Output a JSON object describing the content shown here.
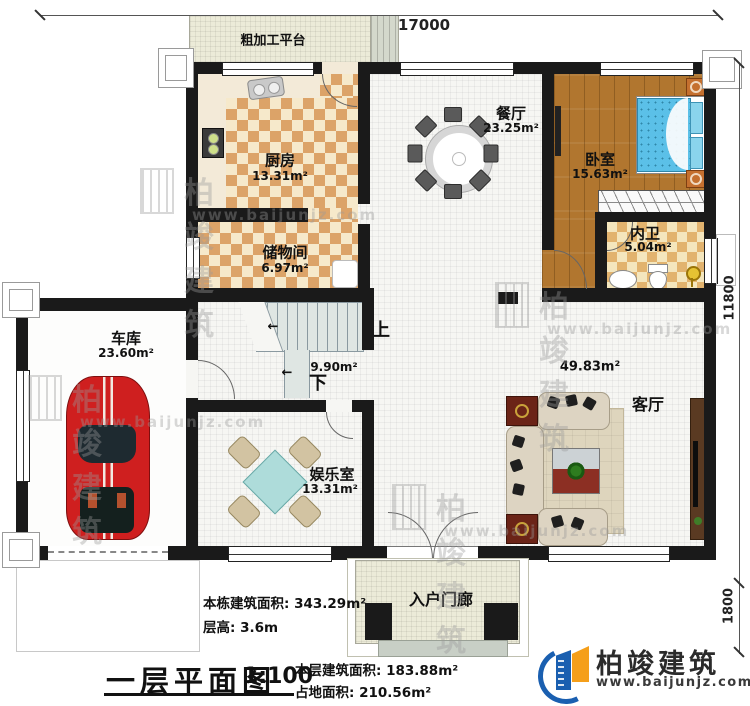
{
  "dimensions": {
    "top": "17000",
    "right": "11800",
    "porch": "1800"
  },
  "outdoor": {
    "platform": "粗加工平台",
    "porch": "入户门廊"
  },
  "rooms": [
    {
      "id": "kitchen",
      "name": "厨房",
      "area": "13.31m²"
    },
    {
      "id": "dining",
      "name": "餐厅",
      "area": "23.25m²"
    },
    {
      "id": "bedroom",
      "name": "卧室",
      "area": "15.63m²"
    },
    {
      "id": "bathroom",
      "name": "内卫",
      "area": "5.04m²"
    },
    {
      "id": "storage",
      "name": "储物间",
      "area": "6.97m²"
    },
    {
      "id": "garage",
      "name": "车库",
      "area": "23.60m²"
    },
    {
      "id": "entertainment",
      "name": "娱乐室",
      "area": "13.31m²"
    },
    {
      "id": "living",
      "name": "客厅",
      "area": "49.83m²"
    }
  ],
  "stairs": {
    "area": "9.90m²",
    "up_label": "上",
    "down_label": "下",
    "arrow": "←"
  },
  "titleblock": {
    "title": "一层平面图",
    "scale": "1:100",
    "building_total_area": "本栋建筑面积: 343.29m²",
    "floor_height": "层高: 3.6m",
    "floor_area": "本层建筑面积: 183.88m²",
    "footprint_area": "占地面积: 210.56m²"
  },
  "logo": {
    "brand": "柏竣建筑",
    "website": "www.baijunjz.com"
  },
  "watermark": {
    "brand": "柏竣建筑",
    "website": "www.baijunjz.com"
  },
  "colors": {
    "wall": "#1a1a1a",
    "logo_blue": "#1a5fb0",
    "logo_orange": "#f59f1a",
    "bed_blue": "#5bc0e8",
    "car_red": "#cf1f1f"
  }
}
